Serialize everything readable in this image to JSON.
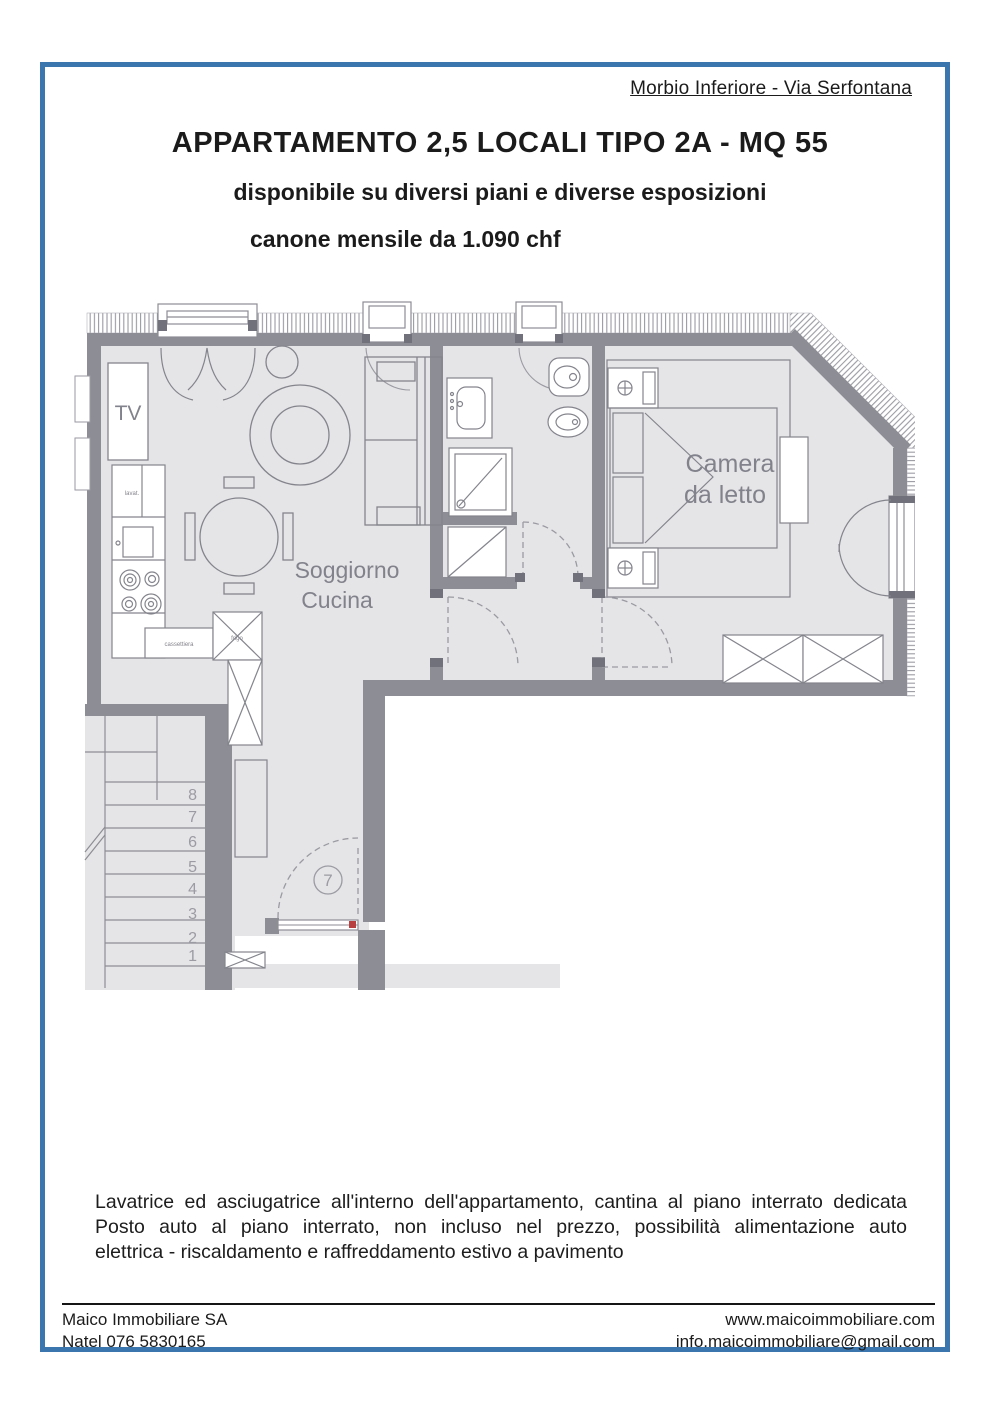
{
  "header": {
    "location": "Morbio Inferiore - Via Serfontana",
    "title": "APPARTAMENTO 2,5 LOCALI TIPO 2A - MQ 55",
    "subtitle": "disponibile su diversi piani e diverse esposizioni",
    "price": "canone mensile da 1.090 chf"
  },
  "floorplan": {
    "rooms": {
      "living_line1": "Soggiorno",
      "living_line2": "Cucina",
      "bedroom_line1": "Camera",
      "bedroom_line2": "da letto",
      "tv": "TV"
    },
    "kitchen_labels": {
      "sink": "lavat.",
      "drawers": "cassettiera",
      "fridge": "frigo"
    },
    "door_number": "7",
    "stair_numbers": [
      "8",
      "7",
      "6",
      "5",
      "4",
      "3",
      "2",
      "1"
    ]
  },
  "description": {
    "line1": "Lavatrice ed asciugatrice all'interno dell'appartamento, cantina al piano interrato dedicata",
    "line2": "Posto auto al piano interrato, non incluso nel prezzo, possibilità alimentazione auto",
    "line3": "elettrica - riscaldamento e raffreddamento estivo a pavimento"
  },
  "footer": {
    "company": "Maico Immobiliare SA",
    "phone": "Natel 076 5830165",
    "website": "www.maicoimmobiliare.com",
    "email": "info.maicoimmobiliare@gmail.com"
  },
  "colors": {
    "frame": "#3b76ae",
    "wall": "#8d8d95",
    "floor": "#e5e5e7",
    "line": "#84848d"
  }
}
